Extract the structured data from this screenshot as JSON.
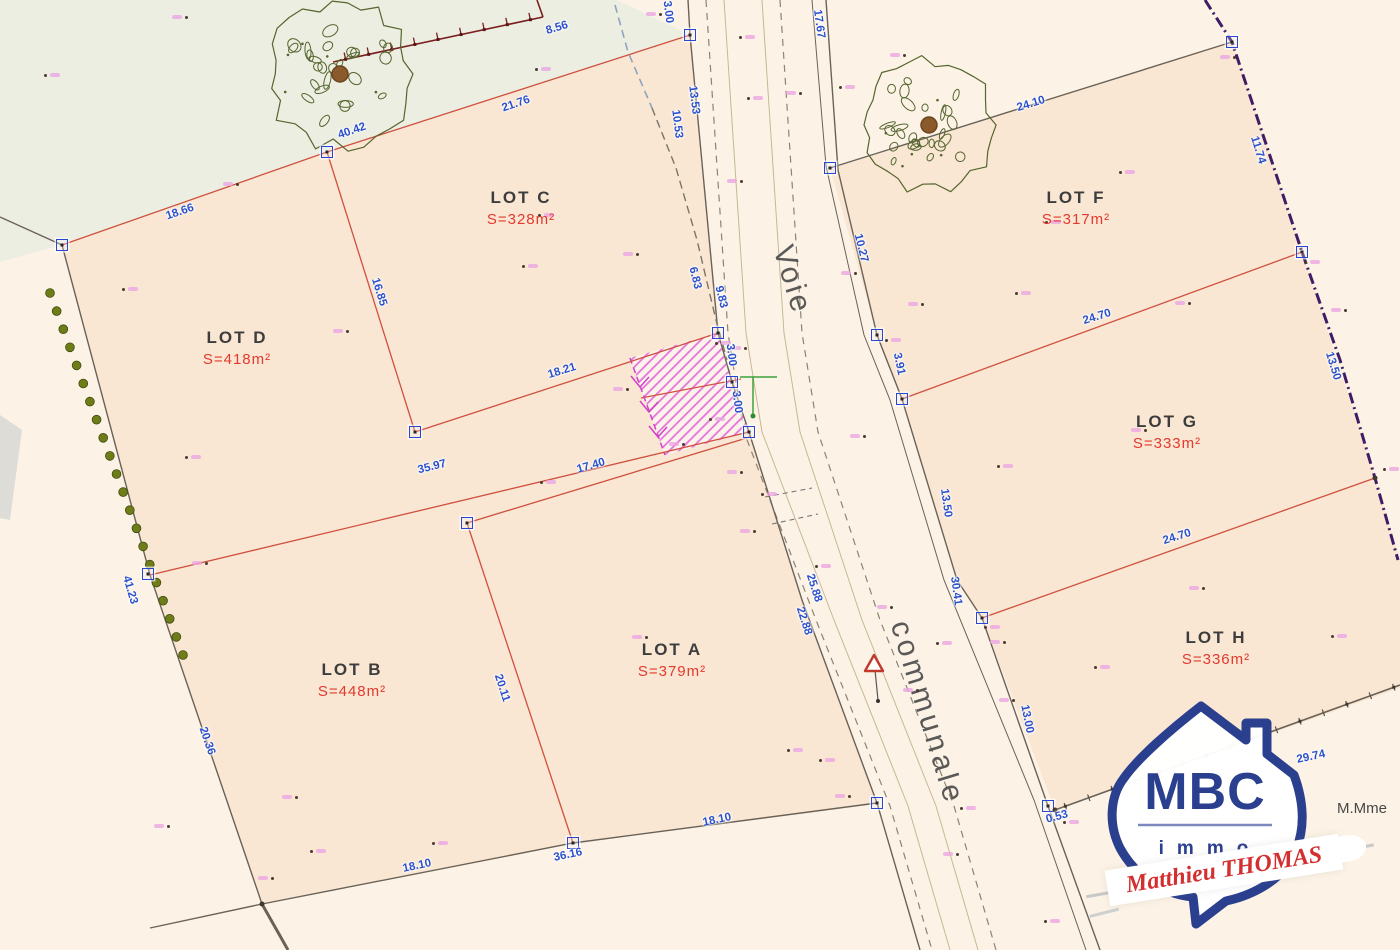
{
  "road": {
    "word1": "Voie",
    "word2": "communale"
  },
  "legal": {
    "party": "M.Mme"
  },
  "logo": {
    "brand": "MBC",
    "sub": "immo",
    "agent": "Matthieu THOMAS"
  },
  "colors": {
    "dimension_blue": "#2b50cc",
    "lot_area_red": "#e4392e",
    "parcel_line_red": "#d0503f",
    "boundary_dark": "#6b6257",
    "limit_purple": "#3f1d66",
    "hatch_pink": "#e673da",
    "hedge_green": "#6f7d18",
    "parcel_fill": "#f9e7d3",
    "sage_fill": "#eceee1",
    "logo_blue": "#2b3f8f",
    "logo_red": "#d32f2f"
  },
  "lots": [
    {
      "id": "a",
      "name": "LOT A",
      "area": "S=379m²",
      "x": 672,
      "y": 660
    },
    {
      "id": "b",
      "name": "LOT B",
      "area": "S=448m²",
      "x": 352,
      "y": 680
    },
    {
      "id": "c",
      "name": "LOT C",
      "area": "S=328m²",
      "x": 521,
      "y": 208
    },
    {
      "id": "d",
      "name": "LOT D",
      "area": "S=418m²",
      "x": 237,
      "y": 348
    },
    {
      "id": "f",
      "name": "LOT F",
      "area": "S=317m²",
      "x": 1076,
      "y": 208
    },
    {
      "id": "g",
      "name": "LOT G",
      "area": "S=333m²",
      "x": 1167,
      "y": 432
    },
    {
      "id": "h",
      "name": "LOT H",
      "area": "S=336m²",
      "x": 1216,
      "y": 648
    }
  ],
  "dimensions": [
    {
      "v": "18.66",
      "x": 180,
      "y": 212,
      "r": -19
    },
    {
      "v": "40.42",
      "x": 352,
      "y": 131,
      "r": -19
    },
    {
      "v": "21.76",
      "x": 516,
      "y": 104,
      "r": -19
    },
    {
      "v": "8.56",
      "x": 557,
      "y": 28,
      "r": -17
    },
    {
      "v": "3.00",
      "x": 668,
      "y": 12,
      "r": 83
    },
    {
      "v": "13.53",
      "x": 694,
      "y": 100,
      "r": 83
    },
    {
      "v": "10.53",
      "x": 677,
      "y": 124,
      "r": 83
    },
    {
      "v": "17.67",
      "x": 819,
      "y": 24,
      "r": 82
    },
    {
      "v": "16.85",
      "x": 379,
      "y": 292,
      "r": 73
    },
    {
      "v": "18.21",
      "x": 562,
      "y": 371,
      "r": -17
    },
    {
      "v": "6.83",
      "x": 695,
      "y": 278,
      "r": 76
    },
    {
      "v": "9.83",
      "x": 721,
      "y": 297,
      "r": 76
    },
    {
      "v": "3.00",
      "x": 731,
      "y": 355,
      "r": 83
    },
    {
      "v": "3.00",
      "x": 737,
      "y": 402,
      "r": 83
    },
    {
      "v": "10.27",
      "x": 861,
      "y": 248,
      "r": 76
    },
    {
      "v": "3.91",
      "x": 899,
      "y": 364,
      "r": 78
    },
    {
      "v": "13.50",
      "x": 946,
      "y": 503,
      "r": 82
    },
    {
      "v": "30.41",
      "x": 956,
      "y": 591,
      "r": 82
    },
    {
      "v": "13.00",
      "x": 1027,
      "y": 719,
      "r": 79
    },
    {
      "v": "0.53",
      "x": 1057,
      "y": 817,
      "r": -15
    },
    {
      "v": "24.10",
      "x": 1031,
      "y": 104,
      "r": -17
    },
    {
      "v": "11.74",
      "x": 1258,
      "y": 150,
      "r": 73
    },
    {
      "v": "24.70",
      "x": 1097,
      "y": 317,
      "r": -17
    },
    {
      "v": "13.50",
      "x": 1333,
      "y": 366,
      "r": 73
    },
    {
      "v": "24.70",
      "x": 1177,
      "y": 537,
      "r": -17
    },
    {
      "v": "29.74",
      "x": 1311,
      "y": 757,
      "r": -12
    },
    {
      "v": "35.97",
      "x": 432,
      "y": 467,
      "r": -14
    },
    {
      "v": "17.40",
      "x": 591,
      "y": 466,
      "r": -16
    },
    {
      "v": "41.23",
      "x": 130,
      "y": 590,
      "r": 74
    },
    {
      "v": "20.36",
      "x": 207,
      "y": 741,
      "r": 71
    },
    {
      "v": "20.11",
      "x": 502,
      "y": 688,
      "r": 72
    },
    {
      "v": "18.10",
      "x": 417,
      "y": 866,
      "r": -12
    },
    {
      "v": "36.16",
      "x": 568,
      "y": 855,
      "r": -12
    },
    {
      "v": "18.10",
      "x": 717,
      "y": 820,
      "r": -12
    },
    {
      "v": "25.88",
      "x": 814,
      "y": 588,
      "r": 72
    },
    {
      "v": "22.88",
      "x": 804,
      "y": 621,
      "r": 72
    }
  ],
  "markers": [
    [
      62,
      245
    ],
    [
      148,
      574
    ],
    [
      327,
      152
    ],
    [
      415,
      432
    ],
    [
      467,
      523
    ],
    [
      573,
      843
    ],
    [
      877,
      803
    ],
    [
      690,
      35
    ],
    [
      718,
      333
    ],
    [
      732,
      382
    ],
    [
      749,
      432
    ],
    [
      830,
      168
    ],
    [
      877,
      335
    ],
    [
      902,
      399
    ],
    [
      982,
      618
    ],
    [
      1048,
      806
    ],
    [
      1232,
      42
    ],
    [
      1302,
      252
    ]
  ],
  "corner_dots": [
    [
      262,
      904
    ],
    [
      1055,
      810
    ],
    [
      1375,
      478
    ]
  ],
  "points": [
    [
      186,
      17
    ],
    [
      45,
      75
    ],
    [
      237,
      184
    ],
    [
      123,
      289
    ],
    [
      347,
      331
    ],
    [
      186,
      457
    ],
    [
      206,
      563
    ],
    [
      311,
      851
    ],
    [
      272,
      878
    ],
    [
      536,
      69
    ],
    [
      660,
      14
    ],
    [
      740,
      37
    ],
    [
      741,
      181
    ],
    [
      539,
      215
    ],
    [
      637,
      254
    ],
    [
      523,
      266
    ],
    [
      296,
      797
    ],
    [
      433,
      843
    ],
    [
      168,
      826
    ],
    [
      748,
      98
    ],
    [
      800,
      93
    ],
    [
      840,
      87
    ],
    [
      922,
      304
    ],
    [
      1016,
      293
    ],
    [
      855,
      273
    ],
    [
      886,
      340
    ],
    [
      864,
      436
    ],
    [
      1046,
      222
    ],
    [
      1234,
      57
    ],
    [
      1305,
      262
    ],
    [
      1345,
      310
    ],
    [
      1384,
      469
    ],
    [
      1189,
      303
    ],
    [
      998,
      466
    ],
    [
      1145,
      430
    ],
    [
      1332,
      636
    ],
    [
      1203,
      588
    ],
    [
      985,
      627
    ],
    [
      1004,
      642
    ],
    [
      937,
      643
    ],
    [
      917,
      690
    ],
    [
      961,
      808
    ],
    [
      1013,
      700
    ],
    [
      1095,
      667
    ],
    [
      891,
      607
    ],
    [
      816,
      566
    ],
    [
      754,
      531
    ],
    [
      762,
      494
    ],
    [
      741,
      472
    ],
    [
      820,
      760
    ],
    [
      849,
      796
    ],
    [
      788,
      750
    ],
    [
      957,
      854
    ],
    [
      1045,
      921
    ],
    [
      646,
      637
    ],
    [
      541,
      482
    ],
    [
      683,
      444
    ],
    [
      710,
      419
    ],
    [
      627,
      389
    ],
    [
      716,
      343
    ],
    [
      745,
      348
    ],
    [
      1064,
      822
    ],
    [
      904,
      55
    ],
    [
      1120,
      172
    ]
  ]
}
